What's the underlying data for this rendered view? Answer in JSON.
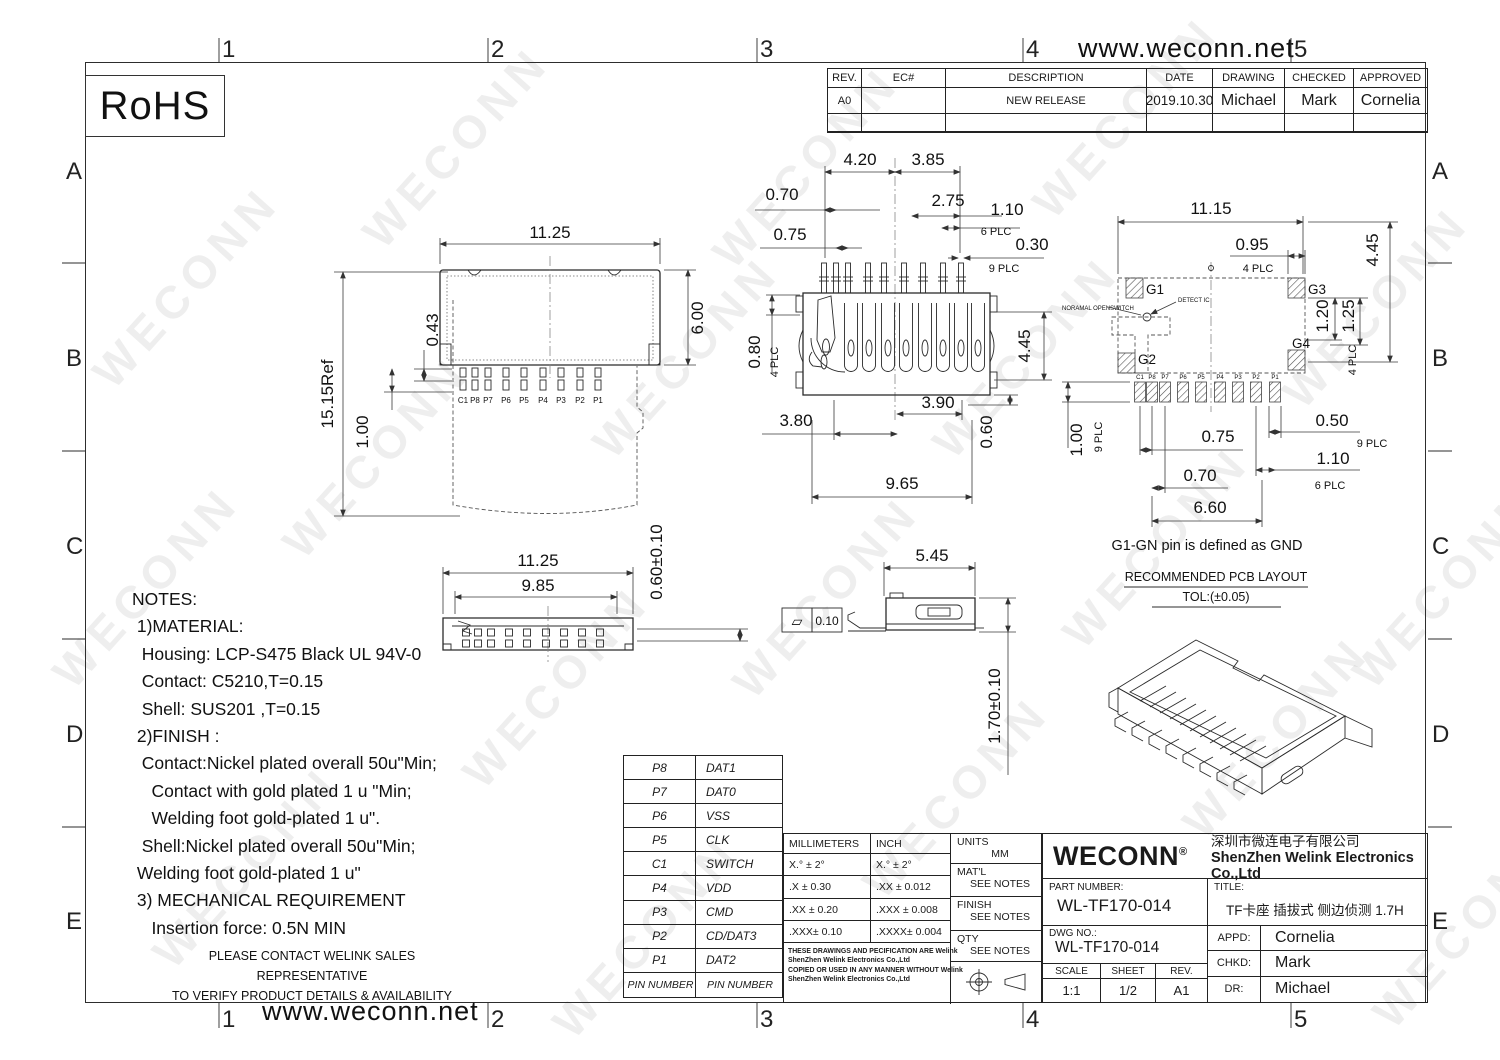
{
  "watermark": {
    "text": "WECONN"
  },
  "frame": {
    "website": "www.weconn.net",
    "cols": [
      "1",
      "2",
      "3",
      "4",
      "5"
    ],
    "rows": [
      "A",
      "B",
      "C",
      "D",
      "E"
    ]
  },
  "rohs": {
    "label": "RoHS"
  },
  "revision_table": {
    "headers": {
      "rev": "REV.",
      "ec": "EC#",
      "description": "DESCRIPTION",
      "date": "DATE",
      "drawing": "DRAWING",
      "checked": "CHECKED",
      "approved": "APPROVED"
    },
    "row": {
      "rev": "A0",
      "ec": "",
      "description": "NEW RELEASE",
      "date": "2019.10.30",
      "drawing": "Michael",
      "checked": "Mark",
      "approved": "Cornelia"
    }
  },
  "notes": {
    "lines": [
      "NOTES:",
      " 1)MATERIAL:",
      "  Housing: LCP-S475 Black UL 94V-0",
      "  Contact: C5210,T=0.15",
      "  Shell: SUS201 ,T=0.15",
      " 2)FINISH :",
      "  Contact:Nickel plated overall 50u\"Min;",
      "    Contact with gold plated 1 u \"Min;",
      "    Welding foot gold-plated 1 u\".",
      "  Shell:Nickel plated overall 50u\"Min;",
      " Welding foot gold-plated 1 u\"",
      " 3) MECHANICAL REQUIREMENT",
      "    Insertion force: 0.5N MIN"
    ],
    "footer": [
      "PLEASE CONTACT WELINK SALES REPRESENTATIVE",
      "TO VERIFY PRODUCT DETAILS & AVAILABILITY"
    ]
  },
  "pin_table": {
    "rows": [
      {
        "pin": "P8",
        "signal": "DAT1"
      },
      {
        "pin": "P7",
        "signal": "DAT0"
      },
      {
        "pin": "P6",
        "signal": "VSS"
      },
      {
        "pin": "P5",
        "signal": "CLK"
      },
      {
        "pin": "C1",
        "signal": "SWITCH"
      },
      {
        "pin": "P4",
        "signal": "VDD"
      },
      {
        "pin": "P3",
        "signal": "CMD"
      },
      {
        "pin": "P2",
        "signal": "CD/DAT3"
      },
      {
        "pin": "P1",
        "signal": "DAT2"
      },
      {
        "pin": "PIN  NUMBER",
        "signal": "PIN  NUMBER"
      }
    ]
  },
  "tolerance_table": {
    "mm_header": "MILLIMETERS",
    "inch_header": "INCH",
    "rows": [
      {
        "mm": "X.°  ±  2°",
        "inch": "X.°  ±  2°"
      },
      {
        "mm": ".X   ± 0.30",
        "inch": ".XX   ± 0.012"
      },
      {
        "mm": ".XX  ± 0.20",
        "inch": ".XXX  ± 0.008"
      },
      {
        "mm": ".XXX± 0.10",
        "inch": ".XXXX± 0.004"
      }
    ],
    "legal": [
      "THESE DRAWINGS AND PECIFICATION ARE Welink",
      "ShenZhen Welink Electronics Co.,Ltd",
      " COPIED OR USED IN ANY MANNER WITHOUT Welink",
      "ShenZhen Welink Electronics Co.,Ltd"
    ]
  },
  "info_block": {
    "units_label": "UNITS",
    "units": "MM",
    "matl_label": "MAT'L",
    "matl": "SEE NOTES",
    "finish_label": "FINISH",
    "finish": "SEE NOTES",
    "qty_label": "QTY",
    "qty": "SEE NOTES"
  },
  "title_block": {
    "brand": "WECONN",
    "reg": "®",
    "company_cn": "深圳市微连电子有限公司",
    "company_en": "ShenZhen Welink Electronics Co.,Ltd",
    "part_number_label": "PART NUMBER:",
    "part_number": "WL-TF170-014",
    "title_label": "TITLE:",
    "title": "TF卡座 插拔式 侧边侦测 1.7H",
    "dwg_no_label": "DWG NO.:",
    "dwg_no": "WL-TF170-014",
    "appd_label": "APPD:",
    "appd": "Cornelia",
    "chkd_label": "CHKD:",
    "chkd": "Mark",
    "dr_label": "DR:",
    "dr": "Michael",
    "scale_label": "SCALE",
    "scale": "1:1",
    "sheet_label": "SHEET",
    "sheet": "1/2",
    "rev_label": "REV.",
    "rev": "A1"
  },
  "views": {
    "top": {
      "dim_width": "11.25",
      "dim_height": "6.00",
      "dim_offset": "0.43",
      "dim_pin": "1.00",
      "dim_ref": "15.15Ref",
      "pins": [
        "C1",
        "P8",
        "P7",
        "P6",
        "P5",
        "P4",
        "P3",
        "P2",
        "P1"
      ]
    },
    "front": {
      "d1": "4.20",
      "d2": "3.85",
      "d3": "0.70",
      "d4": "2.75",
      "d5": "1.10",
      "d5n": "6 PLC",
      "d6": "0.75",
      "d7": "0.30",
      "d7n": "9 PLC",
      "d8": "0.80",
      "d8n": "4 PLC",
      "d9": "4.45",
      "d10": "3.90",
      "d11": "3.80",
      "d12": "0.60",
      "d13": "9.65"
    },
    "pcb": {
      "d1": "11.15",
      "d2": "0.95",
      "d2n": "4 PLC",
      "d3": "4.45",
      "d4": "1.20",
      "d5": "1.25",
      "d5n": "4 PLC",
      "g1": "G1",
      "g2": "G2",
      "g3": "G3",
      "g4": "G4",
      "switch_label": "NORAMAL OPENSWITCH",
      "detect_label": "DETECT IC",
      "pins": [
        "C1",
        "P8",
        "P7",
        "P6",
        "P5",
        "P4",
        "P3",
        "P2",
        "P1"
      ],
      "d6": "1.00",
      "d6n": "9 PLC",
      "d7": "0.75",
      "d8": "0.70",
      "d9": "0.50",
      "d9n": "9 PLC",
      "d10": "1.10",
      "d10n": "6 PLC",
      "d11": "6.60",
      "gnd_note": "G1-GN pin is defined as GND",
      "pcb_title": "RECOMMENDED PCB LAYOUT",
      "pcb_tol": "TOL:(±0.05)"
    },
    "bottom": {
      "d1": "11.25",
      "d2": "9.85",
      "d3": "0.60±0.10"
    },
    "side": {
      "d1": "5.45",
      "flatness": "0.10",
      "flatness_symbol": "▱",
      "d2": "1.70±0.10"
    }
  }
}
